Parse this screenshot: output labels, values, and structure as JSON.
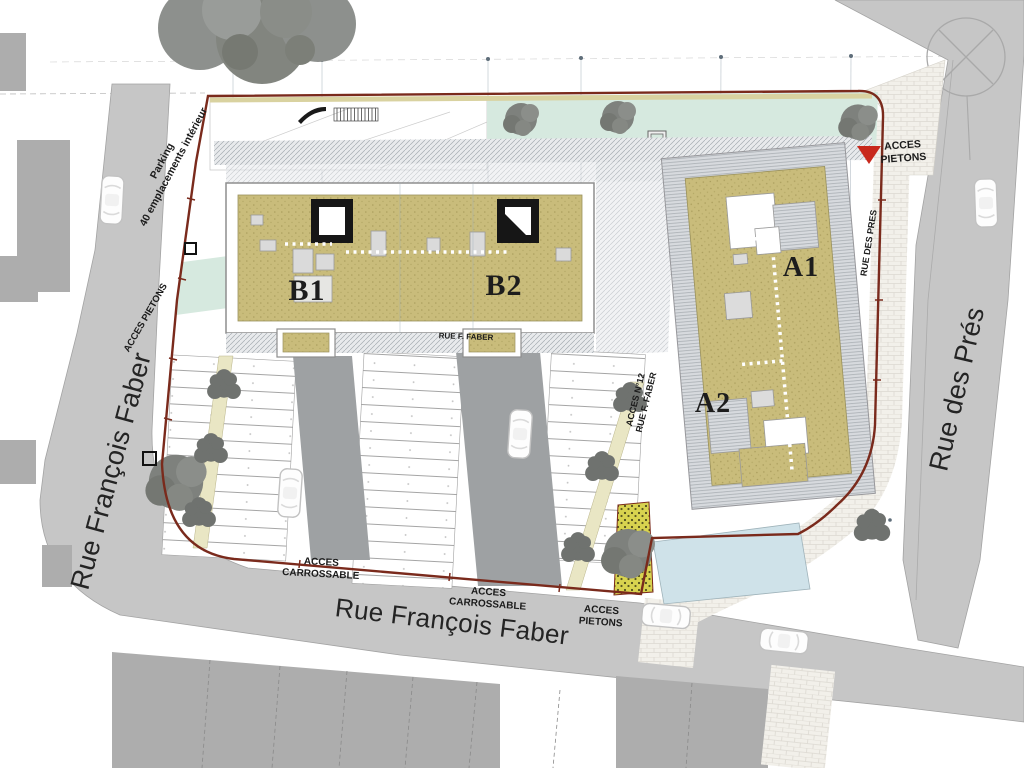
{
  "plan": {
    "streets": {
      "rue_francois_faber": "Rue François Faber",
      "rue_des_pres": "Rue des Prés",
      "rue_des_pres_caps": "RUE DES PRES",
      "rue_f_faber_caps": "RUE F. FABER"
    },
    "parking_note": {
      "line1": "Parking",
      "line2": "40 emplacements intérieur"
    },
    "access": {
      "pietons_joined": "ACCES PIETONS",
      "pietons_line1": "ACCES",
      "pietons_line2": "PIETONS",
      "carrossable_line1": "ACCES",
      "carrossable_line2": "CARROSSABLE",
      "n12_line1": "ACCES N°12",
      "n12_line2": "RUE F. FABER"
    },
    "buildings": {
      "b1": "B1",
      "b2": "B2",
      "a1": "A1",
      "a2": "A2"
    },
    "legend_colors": {
      "site_boundary": "#7a2a1c",
      "roof": "#c8bb7a",
      "lawn": "#d6e9df",
      "water": "#cfe2e9",
      "road": "#c6c6c6",
      "neighbor_building": "#adadad",
      "driveway": "#9ea1a3",
      "paving": "#f1efe9",
      "planting": "#d8d34f",
      "access_marker": "#c8281c"
    }
  }
}
